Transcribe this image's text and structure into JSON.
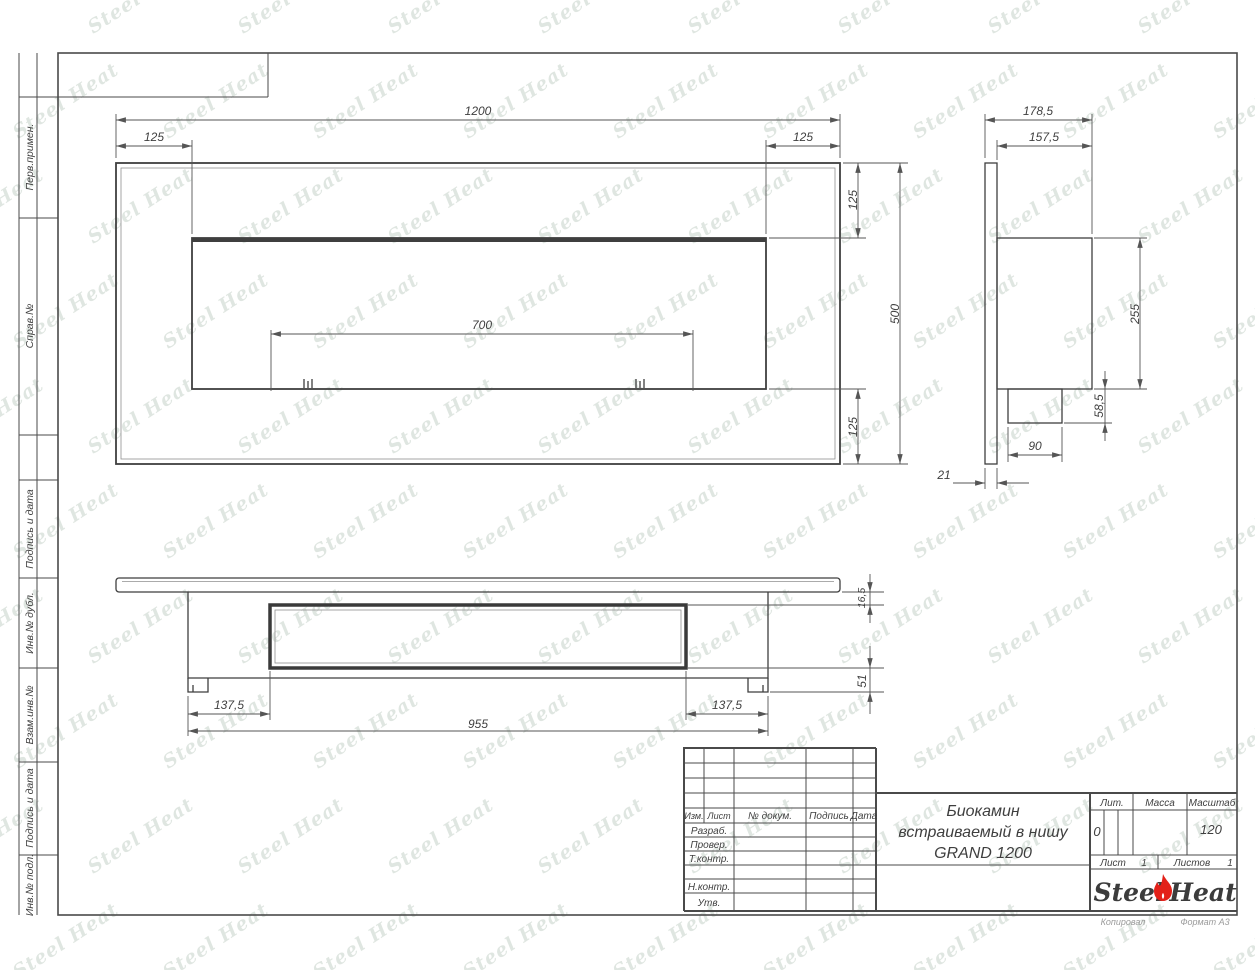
{
  "margin_labels": [
    "Перв.примен.",
    "Справ.№",
    "Подпись и дата",
    "Инв.№ дубл.",
    "Взам.инв.№",
    "Подпись и дата",
    "Инв.№ подл."
  ],
  "dims": {
    "front": {
      "overall_width": "1200",
      "left_offset": "125",
      "right_offset": "125",
      "burner_width": "700",
      "top_offset": "125",
      "height": "500",
      "bottom_offset": "125"
    },
    "side": {
      "overall_depth": "178,5",
      "body_depth": "157,5",
      "body_height": "255",
      "burner_height": "58,5",
      "burner_width": "90",
      "panel_thickness": "21"
    },
    "bottom": {
      "panel_lip": "16,5",
      "foot_height": "51",
      "left_offset": "137,5",
      "body_width": "955",
      "right_offset": "137,5"
    }
  },
  "title_block": {
    "revision_headers": {
      "izm": "Изм.",
      "list": "Лист",
      "doc": "№ докум.",
      "sign": "Подпись",
      "date": "Дата"
    },
    "roles": {
      "developed": "Разраб.",
      "checked": "Провер.",
      "tcontrol": "Т.контр.",
      "ncontrol": "Н.контр.",
      "approved": "Утв."
    },
    "title_line1": "Биокамин",
    "title_line2": "встраиваемый в нишу",
    "title_line3": "GRAND 1200",
    "lit_label": "Лит.",
    "lit_value": "0",
    "mass_label": "Масса",
    "scale_label": "Масштаб",
    "scale_value": "120",
    "sheet_label": "Лист",
    "sheet_value": "1",
    "sheets_label": "Листов",
    "sheets_value": "1",
    "logo_part1": "Steel",
    "logo_part2": "Heat"
  },
  "footer": {
    "copied": "Копировал",
    "format": "Формат А3"
  },
  "watermark": {
    "text": "Steel Heat"
  },
  "colors": {
    "line": "#474747",
    "dim_text": "#3f3f3f",
    "accent_red": "#e32119",
    "watermark": "#9fb3a3",
    "footer_text": "#9b9b9b"
  }
}
